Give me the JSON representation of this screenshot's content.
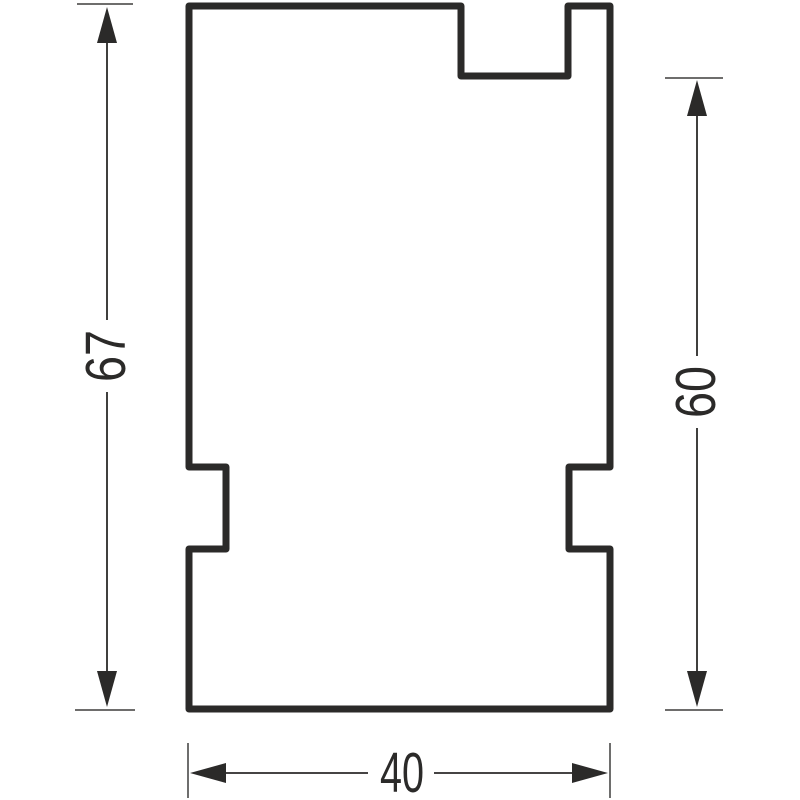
{
  "drawing": {
    "kind": "technical-profile-drawing",
    "background_color": "#ffffff",
    "line_color": "#2b2a29",
    "part": "stepped-profile-outline",
    "dimensions": {
      "overall_height": {
        "value": "67",
        "orientation": "vertical",
        "position": "left"
      },
      "tab_height": {
        "value": "60",
        "orientation": "vertical",
        "position": "right"
      },
      "overall_width": {
        "value": "40",
        "orientation": "horizontal",
        "position": "bottom"
      }
    }
  }
}
